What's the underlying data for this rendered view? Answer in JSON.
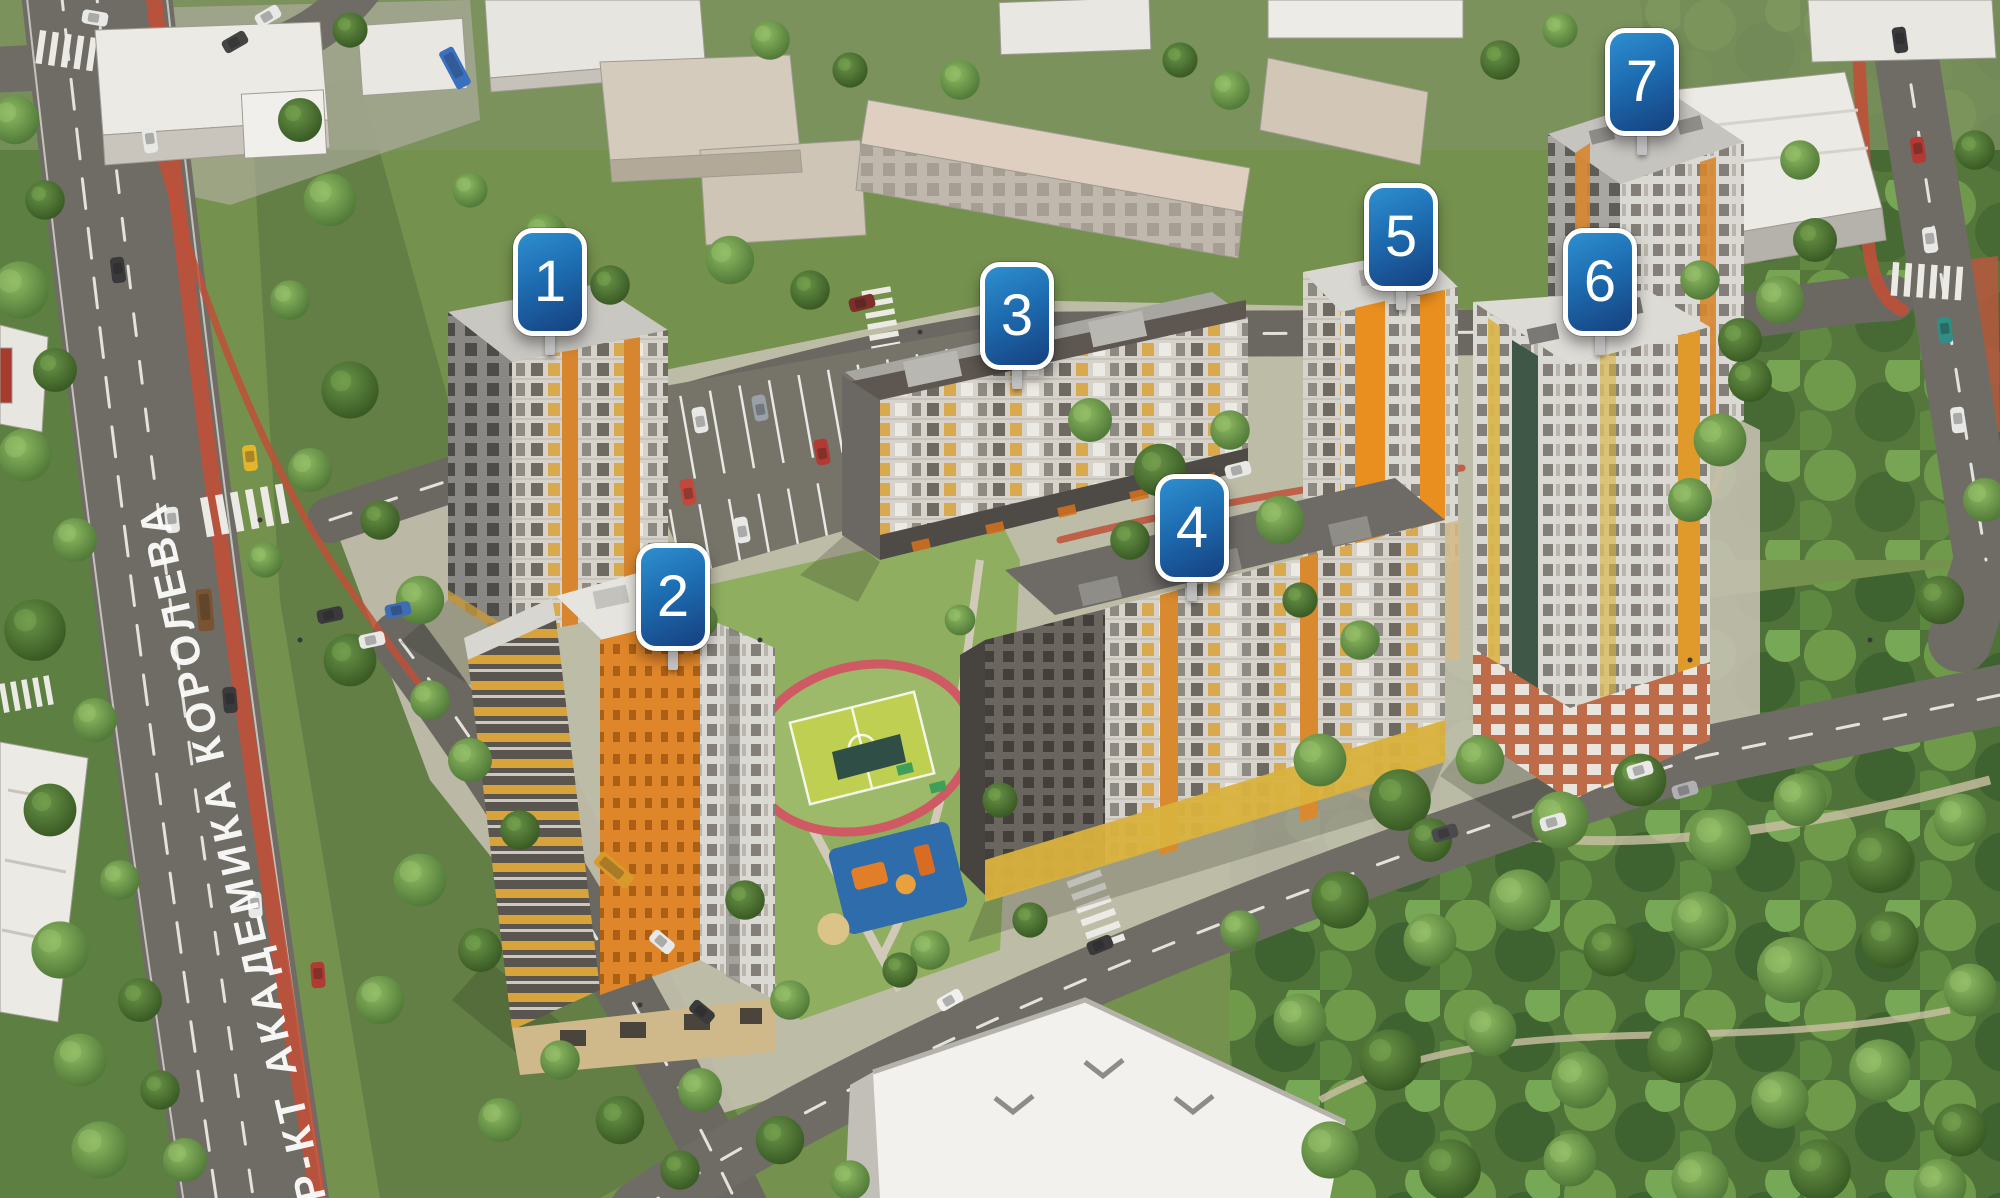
{
  "map": {
    "street_label": "ПР-КТ АКАДЕМИКА КОРОЛЕВА",
    "building_markers": [
      {
        "label": "1"
      },
      {
        "label": "2"
      },
      {
        "label": "3"
      },
      {
        "label": "4"
      },
      {
        "label": "5"
      },
      {
        "label": "6"
      },
      {
        "label": "7"
      }
    ],
    "colors": {
      "marker_blue_top": "#2e8fd0",
      "marker_blue_bottom": "#16407f",
      "marker_border": "#ffffff",
      "road_asphalt": "#6f6c66",
      "bike_lane_red": "#bf5038",
      "facade_orange": "#e0862a",
      "facade_yellow": "#d9b23c",
      "brick_base": "#bf6a48",
      "roof_light": "#e2e0db",
      "foliage_green": "#4f7238"
    }
  }
}
